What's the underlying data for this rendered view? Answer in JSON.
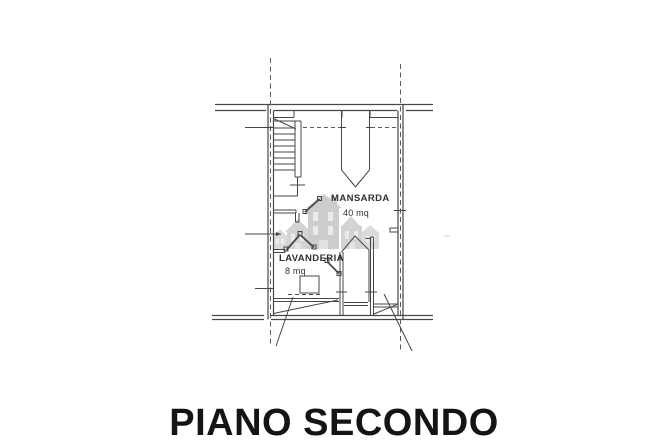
{
  "title": "PIANO SECONDO",
  "floor_plan": {
    "rooms": [
      {
        "name": "MANSARDA",
        "area": "40 mq"
      },
      {
        "name": "LAVANDERIA",
        "area": "8 mq"
      }
    ],
    "watermark_icon": "houses-logo-icon"
  },
  "colors": {
    "background": "#ffffff",
    "line": "#474747",
    "dashed_line": "#5a5a5a",
    "watermark": "#a5a5a5",
    "title_text": "#141414"
  }
}
